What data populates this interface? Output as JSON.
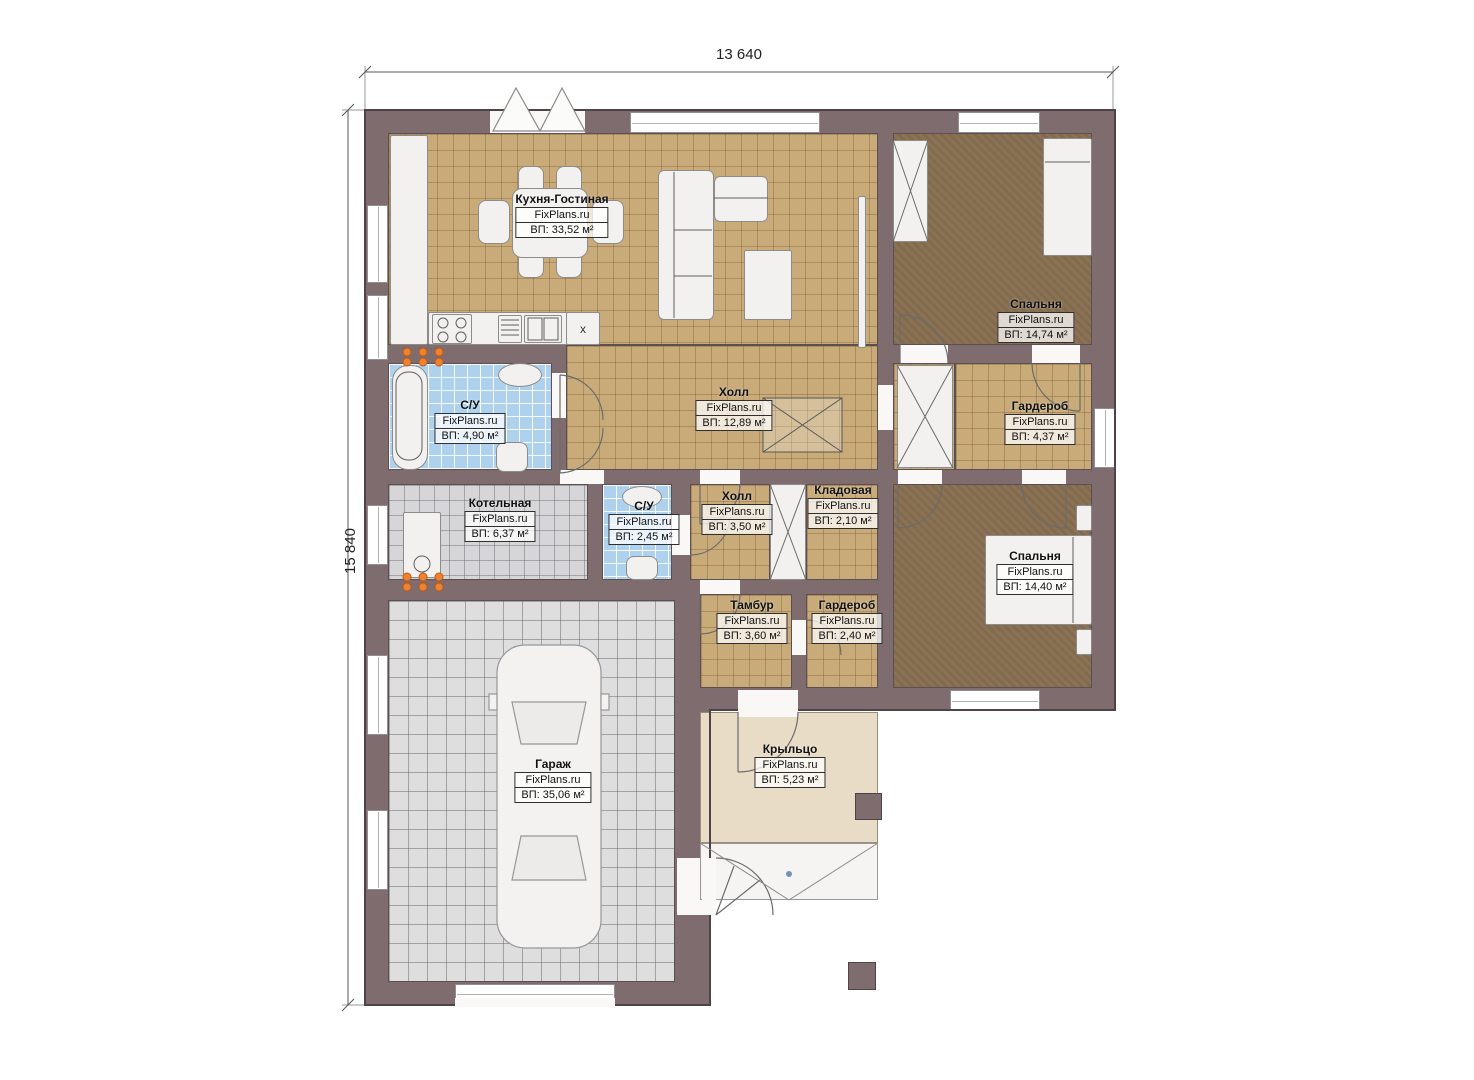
{
  "watermark": "FixPlans.ru",
  "dimensions": {
    "top": "13 640",
    "left": "15 840"
  },
  "rooms": {
    "kitchen_living": {
      "name": "Кухня-Гостиная",
      "area": "ВП: 33,52 м²"
    },
    "bedroom_top": {
      "name": "Спальня",
      "area": "ВП: 14,74 м²"
    },
    "wardrobe_top": {
      "name": "Гардероб",
      "area": "ВП: 4,37 м²"
    },
    "bathroom_main": {
      "name": "С/У",
      "area": "ВП: 4,90 м²"
    },
    "hall_main": {
      "name": "Холл",
      "area": "ВП: 12,89 м²"
    },
    "boiler": {
      "name": "Котельная",
      "area": "ВП: 6,37 м²"
    },
    "bathroom_small": {
      "name": "С/У",
      "area": "ВП: 2,45 м²"
    },
    "hall_small": {
      "name": "Холл",
      "area": "ВП: 3,50 м²"
    },
    "storage": {
      "name": "Кладовая",
      "area": "ВП: 2,10 м²"
    },
    "vestibule": {
      "name": "Тамбур",
      "area": "ВП: 3,60 м²"
    },
    "wardrobe_small": {
      "name": "Гардероб",
      "area": "ВП: 2,40 м²"
    },
    "bedroom_bottom": {
      "name": "Спальня",
      "area": "ВП: 14,40 м²"
    },
    "garage": {
      "name": "Гараж",
      "area": "ВП: 35,06 м²"
    },
    "porch": {
      "name": "Крыльцо",
      "area": "ВП: 5,23 м²"
    }
  },
  "annotations": {
    "washer_mark": "x"
  },
  "colors": {
    "wall": "#7e6c6e",
    "wall_outline": "#4f4347",
    "floor_tile_tan": "#c9ab7a",
    "floor_carpet_brown": "#8b7254",
    "floor_bath_blue": "#aed2ee",
    "floor_boiler_gray": "#d6d6d8",
    "floor_garage_gray": "#dededf",
    "floor_porch_beige": "#e9dcc6",
    "radiator_orange": "#ef8230",
    "furniture_white": "#f2f1ef"
  }
}
